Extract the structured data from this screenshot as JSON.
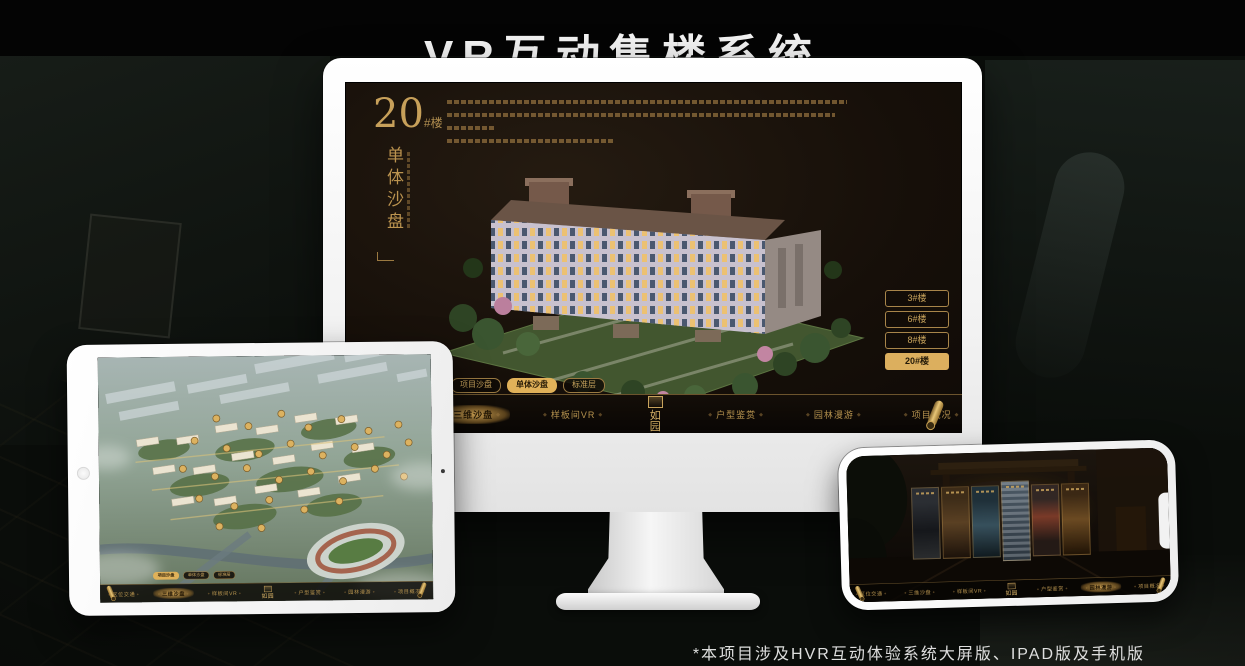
{
  "page": {
    "title": "VR互动售楼系统",
    "footnote": "*本项目涉及HVR互动体验系统大屏版、IPAD版及手机版"
  },
  "colors": {
    "gold": "#C9A45C",
    "gold_active": "#E0B159",
    "screen_brown": "#171007",
    "title_white": "#F4F4F4"
  },
  "monitor_app": {
    "headline": {
      "number": "20",
      "suffix": "#楼",
      "subtitle": "单体沙盘"
    },
    "floor_buttons": [
      {
        "label": "3#楼",
        "active": false
      },
      {
        "label": "6#楼",
        "active": false
      },
      {
        "label": "8#楼",
        "active": false
      },
      {
        "label": "20#楼",
        "active": true
      }
    ],
    "sub_tabs": [
      {
        "label": "项目沙盘",
        "active_on_monitor": false,
        "active_on_tablet": true
      },
      {
        "label": "单体沙盘",
        "active_on_monitor": true,
        "active_on_tablet": false
      },
      {
        "label": "标准层",
        "active_on_monitor": false,
        "active_on_tablet": false
      }
    ]
  },
  "app_nav": {
    "logo": "如园",
    "items": [
      {
        "label": "区位交通"
      },
      {
        "label": "三维沙盘"
      },
      {
        "label": "样板间VR"
      },
      {
        "label": "户型鉴赏"
      },
      {
        "label": "园林漫游"
      },
      {
        "label": "项目概况"
      }
    ]
  }
}
